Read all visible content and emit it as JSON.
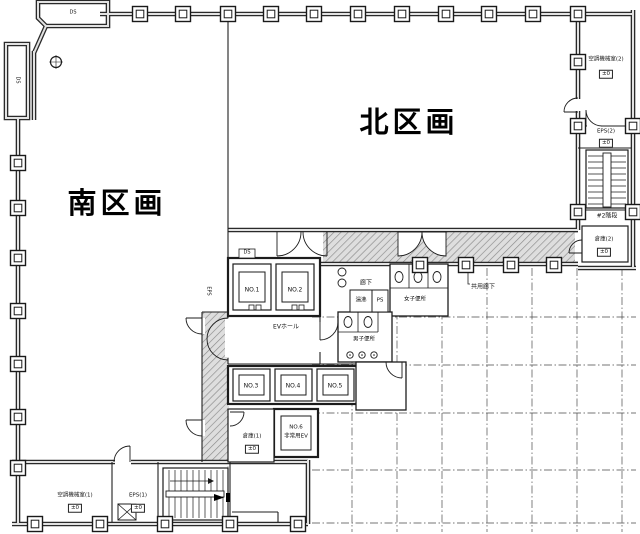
{
  "sections": {
    "south": "南区画",
    "north": "北区画"
  },
  "rooms": {
    "machine_room_2": {
      "name": "空調機械室(2)",
      "level": "±0"
    },
    "eps_2": {
      "name": "EPS(2)",
      "level": "±0"
    },
    "stair_2": {
      "name": "#2階段"
    },
    "storage_2": {
      "name": "倉庫(2)",
      "level": "±0"
    },
    "storage_1": {
      "name": "倉庫(1)",
      "level": "±0"
    },
    "machine_room_1": {
      "name": "空調機械室(1)",
      "level": "±0"
    },
    "eps_1": {
      "name": "EPS(1)",
      "level": "±0"
    },
    "corridor": {
      "name": "廊下"
    },
    "hot_water": {
      "name": "湯沸"
    },
    "pipe_shaft": {
      "name": "PS"
    },
    "womens_toilet": {
      "name": "女子便所"
    },
    "mens_toilet": {
      "name": "男子便所"
    },
    "ev_hall": {
      "name": "EVホール"
    }
  },
  "elevators": {
    "no1": "NO.1",
    "no2": "NO.2",
    "no3": "NO.3",
    "no4": "NO.4",
    "no5": "NO.5",
    "no6_line1": "NO.6",
    "no6_line2": "非常用EV"
  },
  "shafts": {
    "ds_top": "DS",
    "ds_left": "DS",
    "ds_core": "DS",
    "eps_core": "EPS"
  },
  "annotations": {
    "corridor_note": "共用廊下"
  },
  "colors": {
    "background": "#ffffff",
    "line": "#1c1c1c",
    "wall_fill": "#e0e0e0",
    "hatch": "#8f8f8f"
  }
}
